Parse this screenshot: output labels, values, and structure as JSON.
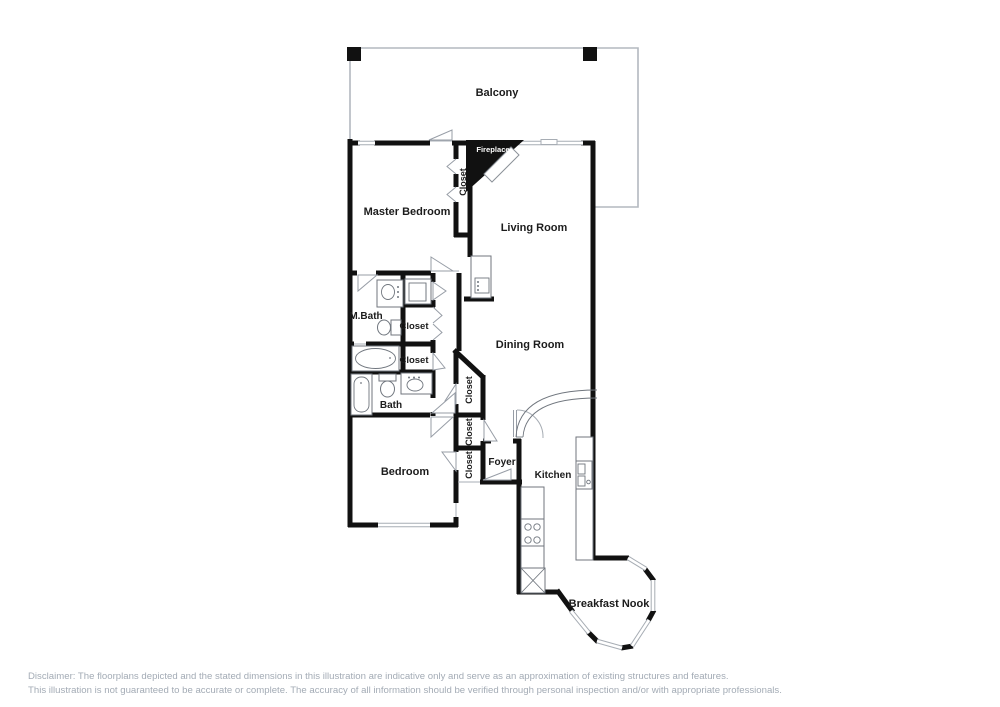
{
  "rooms": {
    "balcony": "Balcony",
    "master_bedroom": "Master Bedroom",
    "living_room": "Living Room",
    "dining_room": "Dining Room",
    "m_bath": "M.Bath",
    "bath": "Bath",
    "bedroom": "Bedroom",
    "foyer": "Foyer",
    "kitchen": "Kitchen",
    "breakfast_nook": "Breakfast Nook",
    "fireplace": "Fireplace"
  },
  "closets": {
    "master": "Closet",
    "hall_upper": "Closet",
    "hall_lower": "Closet",
    "dining": "Closet",
    "foyer": "Closet",
    "bedroom": "Closet"
  },
  "fixtures": {
    "master_bath": [
      "sink-vanity",
      "toilet",
      "bathtub",
      "shower"
    ],
    "bath": [
      "bathtub",
      "toilet",
      "sink-vanity"
    ],
    "hall": [
      "wet-bar-sink"
    ],
    "kitchen": [
      "stove",
      "double-sink",
      "counter",
      "appliance-x"
    ],
    "living_room": [
      "fireplace-hearth"
    ]
  },
  "colors": {
    "wall": "#111111",
    "thin_line": "#a7adb4",
    "label_text": "#1c1c1c",
    "fireplace_fill": "#111111",
    "disclaimer_text": "#a3abb5",
    "background": "#ffffff"
  },
  "disclaimer": {
    "line1": "Disclaimer: The floorplans depicted and the stated dimensions in this illustration are indicative only and serve as an approximation of existing structures and features.",
    "line2": "This illustration is not guaranteed to be accurate or complete. The accuracy of all information should be verified through personal inspection and/or with appropriate professionals."
  }
}
